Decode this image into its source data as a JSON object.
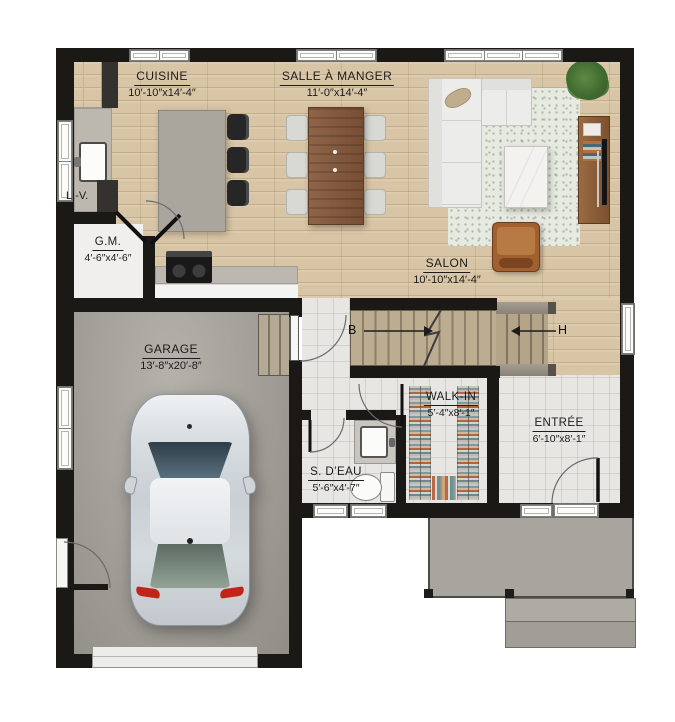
{
  "rooms": {
    "cuisine": {
      "name": "CUISINE",
      "dims": "10′-10″x14′-4″"
    },
    "salle_a_manger": {
      "name": "SALLE À MANGER",
      "dims": "11′-0″x14′-4″"
    },
    "salon": {
      "name": "SALON",
      "dims": "10′-10″x14′-4″"
    },
    "gm": {
      "name": "G.M.",
      "dims": "4′-6″x4′-6″"
    },
    "garage": {
      "name": "GARAGE",
      "dims": "13′-8″x20′-8″"
    },
    "s_deau": {
      "name": "S. D’EAU",
      "dims": "5′-6″x4′-7″"
    },
    "walk_in": {
      "name": "WALK-IN",
      "dims": "5′-4″x8′-1″"
    },
    "entree": {
      "name": "ENTRÉE",
      "dims": "6′-10″x8′-1″"
    }
  },
  "appliances": {
    "lave_vaisselle": "L.-V."
  },
  "stairs": {
    "down": "B",
    "up": "H"
  },
  "colors": {
    "wall": "#1a1916",
    "hardwood": "#d8c5a5",
    "tile": "#e8e6e2",
    "concrete": "#a19d97",
    "table_wood": "#85573a",
    "leather_chair": "#a3602f",
    "taillight_red": "#c22418"
  }
}
